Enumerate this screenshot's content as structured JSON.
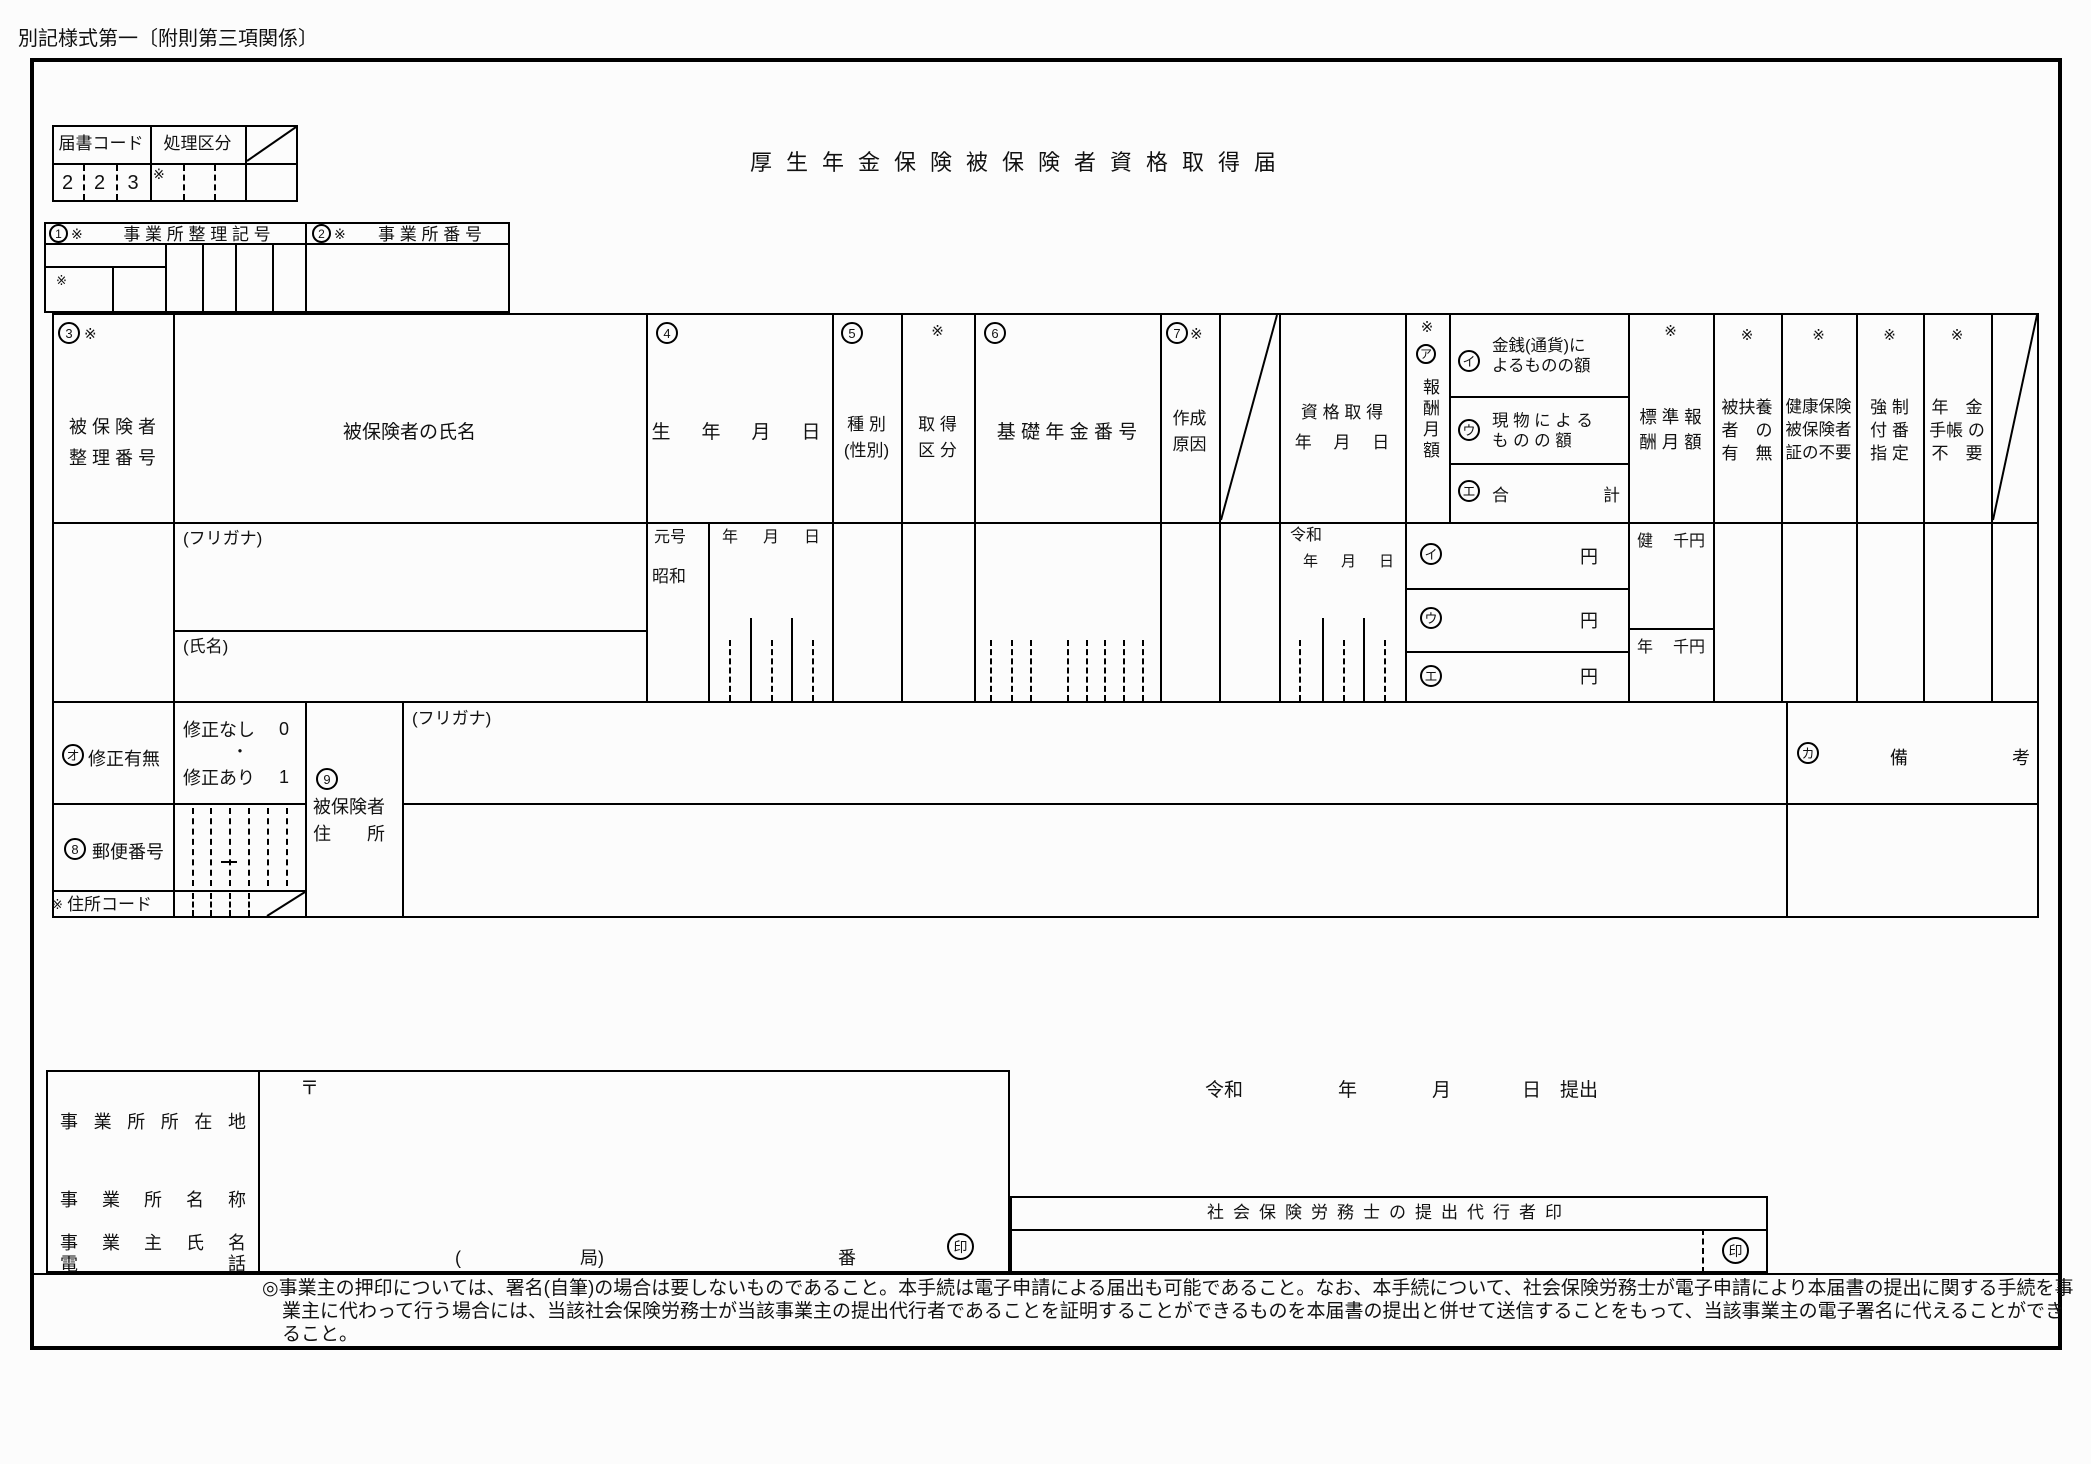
{
  "page": {
    "corner_label": "別記様式第一〔附則第三項関係〕",
    "title": "厚生年金保険被保険者資格取得届"
  },
  "codebox": {
    "h1": "届書コード",
    "h2": "処理区分",
    "digits": [
      "2",
      "2",
      "3"
    ],
    "mark": "※"
  },
  "office": {
    "n1": "1",
    "m1": "※",
    "l1": "事 業 所 整 理 記 号",
    "n2": "2",
    "m2": "※",
    "l2": "事 業 所 番 号",
    "sub_mark": "※"
  },
  "head": {
    "insured": {
      "n": "3",
      "m": "※",
      "label": "被 保 険 者\n整 理 番 号"
    },
    "name": {
      "label": "被保険者の氏名"
    },
    "birth": {
      "n": "4",
      "label": "生　年　月　日"
    },
    "kind": {
      "n": "5",
      "label": "種 別\n(性別)"
    },
    "acq": {
      "m": "※",
      "label": "取 得\n区 分"
    },
    "basic": {
      "n": "6",
      "label": "基 礎 年 金 番 号"
    },
    "reason": {
      "n": "7",
      "m": "※",
      "label": "作成\n原因"
    },
    "acqdate": {
      "label": "資 格 取 得\n年　 月　 日"
    },
    "pay": {
      "m": "※",
      "c": "ア",
      "label": "報酬月額"
    },
    "cash": {
      "c": "イ",
      "label": "金銭(通貨)に\nよるものの額"
    },
    "inkind": {
      "c": "ウ",
      "label": "現 物 に よ る\nも の の 額"
    },
    "total": {
      "c": "エ",
      "l": "合",
      "r": "計"
    },
    "std": {
      "m": "※",
      "label": "標 準 報\n酬 月 額"
    },
    "dep": {
      "m": "※",
      "label": "被扶養\n者　の\n有　無"
    },
    "card": {
      "m": "※",
      "label": "健康保険\n被保険者\n証の不要"
    },
    "forced": {
      "m": "※",
      "label": "強 制\n付 番\n指 定"
    },
    "book": {
      "m": "※",
      "label": "年　金\n手帳 の\n不　要"
    }
  },
  "row": {
    "furigana": "(フリガナ)",
    "shimei": "(氏名)",
    "gengo": "元号",
    "showa": "昭和",
    "reiwa": "令和",
    "y": "年",
    "mo": "月",
    "d": "日",
    "yen": "円",
    "health": "健",
    "pension": "年",
    "senyen": "千円"
  },
  "row2": {
    "fix": {
      "c": "オ",
      "label": "修正有無",
      "o1": "修正なし",
      "v1": "0",
      "dot": "・",
      "o2": "修正あり",
      "v2": "1"
    },
    "addr": {
      "n": "9",
      "l1": "被保険者",
      "l2": "住　　所",
      "furigana": "(フリガナ)"
    },
    "remarks": {
      "c": "カ",
      "l": "備",
      "r": "考"
    },
    "postal": {
      "n": "8",
      "label": "郵便番号"
    },
    "acode": {
      "m": "※",
      "label": "住所コード"
    }
  },
  "bottom": {
    "labels": [
      "事 業 所 所 在 地",
      "事 業 所 名 称",
      "事 業 主 氏 名",
      "電 話"
    ],
    "yuubin": "〒",
    "p1": "(",
    "p2": "局)",
    "p3": "番",
    "seal": "印",
    "sub": {
      "era": "令和",
      "y": "年",
      "m": "月",
      "d": "日",
      "s": "提出"
    },
    "sr": {
      "title": "社会保険労務士の提出代行者印",
      "seal": "印"
    },
    "note": "◎事業主の押印については、署名(自筆)の場合は要しないものであること。本手続は電子申請による届出も可能であること。なお、本手続について、社会保険労務士が電子申請により本届書の提出に関する手続を事業主に代わって行う場合には、当該社会保険労務士が当該事業主の提出代行者であることを証明することができるものを本届書の提出と併せて送信することをもって、当該事業主の電子署名に代えることができること。"
  }
}
